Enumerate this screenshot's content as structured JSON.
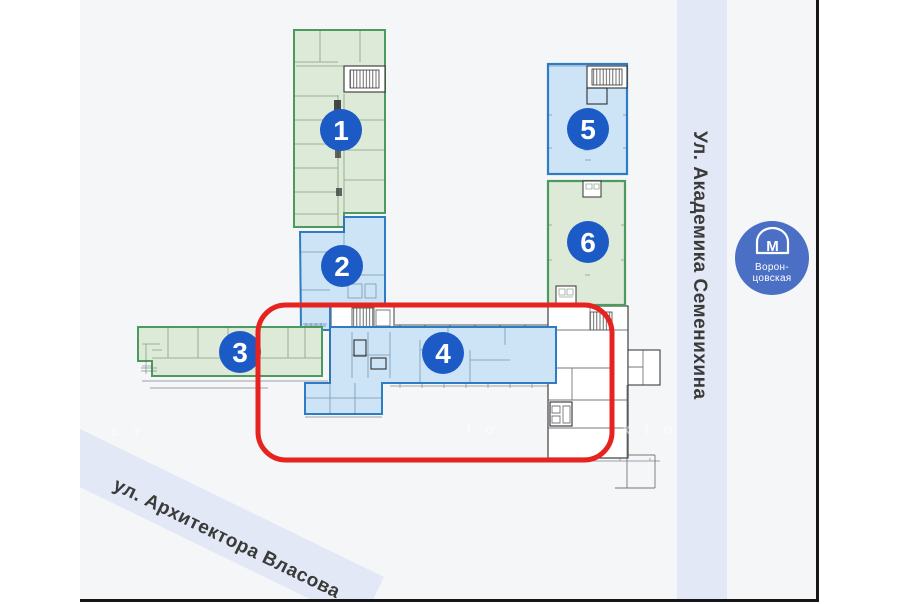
{
  "streets": {
    "vertical_label": "Ул. Академика Семенихина",
    "diagonal_label": "ул. Архитектора Власова"
  },
  "metro": {
    "logo_letter": "М",
    "station_name_line1": "Ворон-",
    "station_name_line2": "цовская"
  },
  "buildings": [
    {
      "number": "1",
      "color": "green",
      "highlighted": false
    },
    {
      "number": "2",
      "color": "blue",
      "highlighted": false
    },
    {
      "number": "3",
      "color": "green",
      "highlighted": false
    },
    {
      "number": "4",
      "color": "blue",
      "highlighted": true
    },
    {
      "number": "5",
      "color": "blue",
      "highlighted": false
    },
    {
      "number": "6",
      "color": "green",
      "highlighted": false
    }
  ],
  "colors": {
    "paper": "#f5f6f8",
    "green_fill": "#ddead7",
    "green_border": "#4c9a60",
    "blue_fill": "#cde4f6",
    "blue_border": "#2d7cc5",
    "badge_blue": "#1c5ac6",
    "highlight_red": "#e6231e",
    "street_band": "#e2e8f5",
    "metro_blue": "#4a6fc4",
    "frame_black": "#161616"
  },
  "watermark": {
    "part1": "е т",
    "part2": "f o",
    "part3": "x f o"
  }
}
